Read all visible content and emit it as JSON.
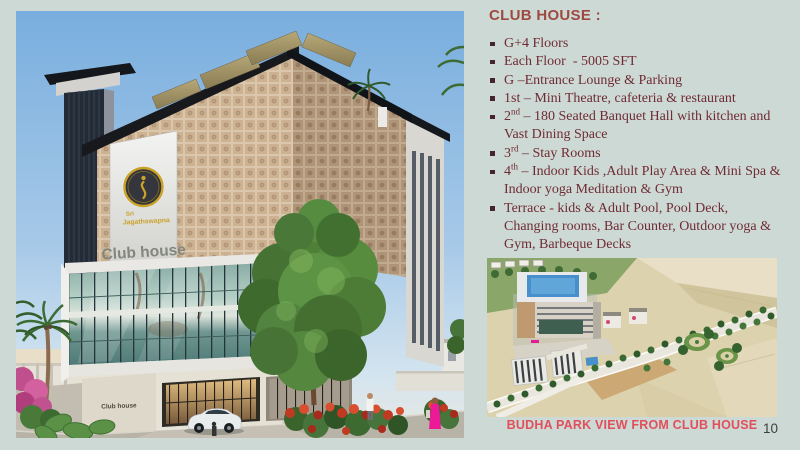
{
  "slide": {
    "page_number": "10",
    "colors": {
      "background": "#cdd9d4",
      "title": "#9e4a40",
      "body_text": "#6f2b35",
      "bullet_marker": "#46242b",
      "caption": "#e0505c",
      "page_number": "#3f3f3f",
      "logo_gold": "#c9a227"
    }
  },
  "right_panel": {
    "title": "CLUB HOUSE :",
    "bullets": [
      {
        "lead": "",
        "sup": "",
        "text": "G+4 Floors"
      },
      {
        "lead": "",
        "sup": "",
        "text": "Each Floor  - 5005 SFT"
      },
      {
        "lead": "",
        "sup": "",
        "text": "G –Entrance Lounge & Parking"
      },
      {
        "lead": "",
        "sup": "",
        "text": "1st – Mini Theatre, cafeteria & restaurant"
      },
      {
        "lead": "2",
        "sup": "nd",
        "text": " – 180 Seated Banquet Hall with kitchen and Vast Dining Space"
      },
      {
        "lead": "3",
        "sup": "rd",
        "text": " – Stay Rooms"
      },
      {
        "lead": "4",
        "sup": "th",
        "text": " – Indoor Kids ,Adult Play Area & Mini Spa & Indoor yoga Meditation & Gym"
      },
      {
        "lead": "",
        "sup": "",
        "text": "Terrace - kids & Adult Pool, Pool Deck, Changing rooms, Bar Counter, Outdoor yoga & Gym, Barbeque Decks"
      }
    ],
    "caption": "BUDHA PARK VIEW FROM CLUB HOUSE"
  },
  "building_render": {
    "logo_top": "Sri",
    "logo_name": "Jagathswapna",
    "panel_title": "Club house",
    "entrance_sign": "Club house"
  }
}
